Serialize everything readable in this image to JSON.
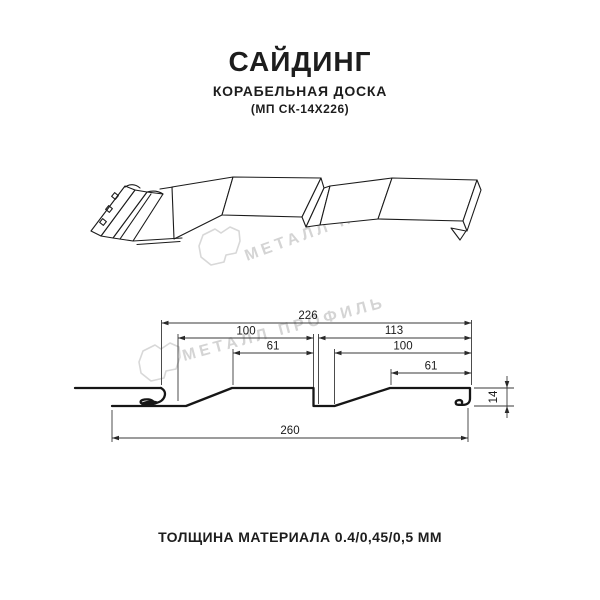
{
  "header": {
    "title": "САЙДИНГ",
    "subtitle": "КОРАБЕЛЬНАЯ ДОСКА",
    "model": "(МП СК-14Х226)"
  },
  "watermark": {
    "text": "МЕТАЛЛ ПРОФИЛЬ",
    "logo_icon": "metal-profil-logo",
    "color": "#d4d4d4"
  },
  "drawing": {
    "views": [
      "3d-profile-view",
      "cross-section-view"
    ]
  },
  "dimensions": {
    "module_width": "226",
    "panel1_width": "100",
    "panel2_width": "113",
    "panel1_flat": "61",
    "panel2_inner": "100",
    "panel2_flat": "61",
    "total_width": "260",
    "profile_depth": "14"
  },
  "footer": {
    "thickness_label": "ТОЛЩИНА МАТЕРИАЛА 0.4/0,45/0,5 ММ"
  },
  "colors": {
    "line": "#1b1b1b",
    "dimension_line": "#3a3a3a",
    "watermark": "#d4d4d4",
    "background": "#ffffff"
  }
}
